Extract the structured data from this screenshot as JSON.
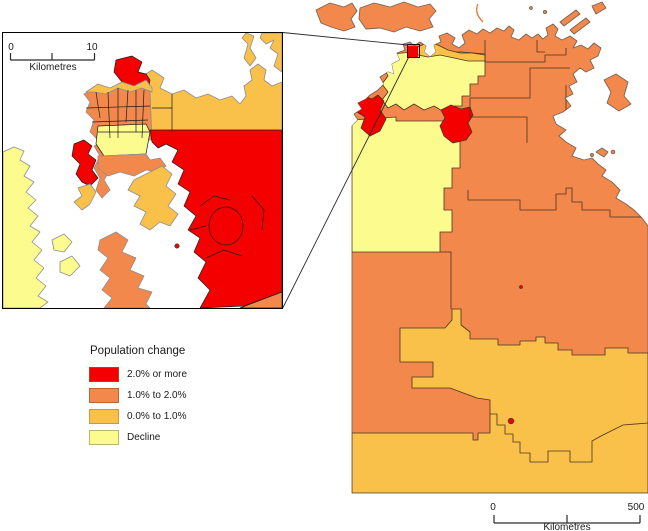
{
  "legend": {
    "title": "Population change",
    "items": [
      {
        "label": "2.0% or more",
        "color": "#f40000",
        "border": "#c23a12"
      },
      {
        "label": "1.0% to 2.0%",
        "color": "#f2884b",
        "border": "#c2632a"
      },
      {
        "label": "0.0% to 1.0%",
        "color": "#f9c04a",
        "border": "#c79a33"
      },
      {
        "label": "Decline",
        "color": "#fcfc8e",
        "border": "#b8b86a"
      }
    ]
  },
  "inset_scalebar": {
    "start": "0",
    "end": "10",
    "unit": "Kilometres"
  },
  "main_scalebar": {
    "start": "0",
    "end": "500",
    "unit": "Kilometres"
  },
  "colors": {
    "red": "#f40000",
    "orange": "#f2884b",
    "amber": "#f9c04a",
    "yellow": "#fcfc8e",
    "sea": "#ffffff",
    "map_coast": "#7a6450",
    "map_border": "#4a3520",
    "inset_coast": "#8e8e8e",
    "inset_border": "#1c1c1c",
    "frame": "#000000",
    "text": "#1a1a1a",
    "scalebar": "#2a2a2a"
  }
}
